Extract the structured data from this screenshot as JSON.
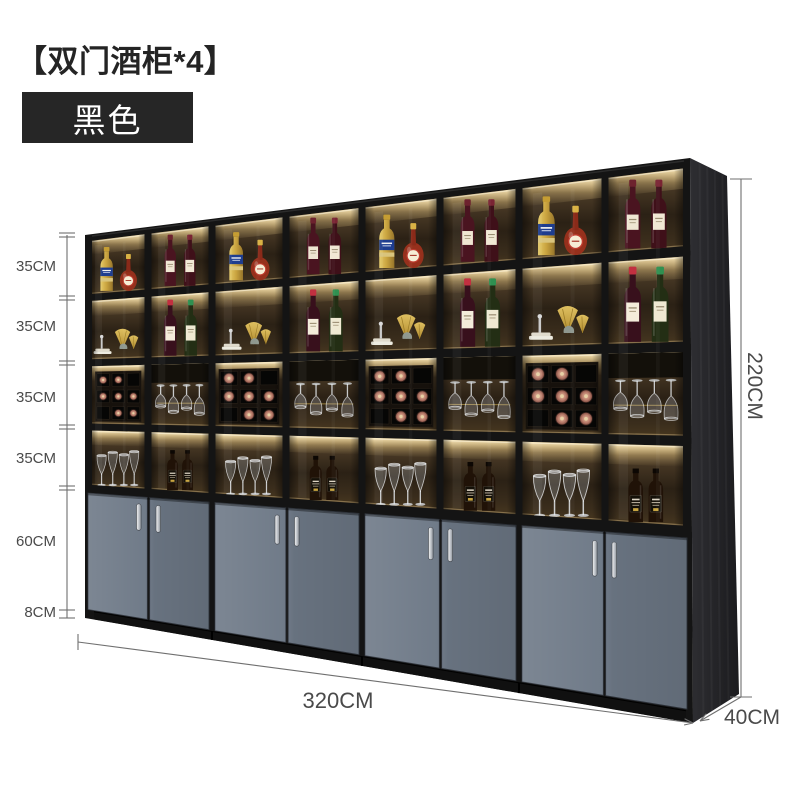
{
  "title": "【双门酒柜*4】",
  "badge": {
    "label": "黑色"
  },
  "dims": {
    "left_labels": [
      "35CM",
      "35CM",
      "35CM",
      "35CM",
      "60CM",
      "8CM"
    ],
    "height": "220CM",
    "width": "320CM",
    "depth": "40CM"
  },
  "colors": {
    "page_bg": "#ffffff",
    "title_text": "#242424",
    "badge_bg": "#262626",
    "badge_text": "#ffffff",
    "dim_text": "#4a4a4a",
    "dim_line": "#6f6f6f",
    "frame": "#141414",
    "glow": "#ffedbe",
    "door": "#6e7987",
    "plinth": "#101010",
    "side_panel": "#26262a",
    "gold": "#c79f3e",
    "wine_bottle": "#4a1420",
    "liquor_gold": "#c9a33f",
    "label_cream": "#f2e9d6"
  },
  "cabinet": {
    "units": 4,
    "doors_per_unit": 2,
    "column_contents": [
      {
        "top": "liquor-pair",
        "upper": "gold-decor",
        "middle": "wine-rack",
        "lower": "wine-glasses"
      },
      {
        "top": "wine-pair",
        "upper": "capped-wine-pair",
        "middle": "hanging-glasses",
        "lower": "whiskey-pair"
      },
      {
        "top": "liquor-pair",
        "upper": "gold-decor",
        "middle": "wine-rack",
        "lower": "wine-glasses"
      },
      {
        "top": "wine-pair",
        "upper": "capped-wine-pair",
        "middle": "hanging-glasses",
        "lower": "whiskey-pair"
      },
      {
        "top": "liquor-pair",
        "upper": "gold-decor",
        "middle": "wine-rack",
        "lower": "wine-glasses"
      },
      {
        "top": "wine-pair",
        "upper": "capped-wine-pair",
        "middle": "hanging-glasses",
        "lower": "whiskey-pair"
      },
      {
        "top": "liquor-pair",
        "upper": "gold-decor",
        "middle": "wine-rack",
        "lower": "wine-glasses"
      },
      {
        "top": "wine-pair",
        "upper": "capped-wine-pair",
        "middle": "hanging-glasses",
        "lower": "whiskey-pair"
      }
    ]
  }
}
